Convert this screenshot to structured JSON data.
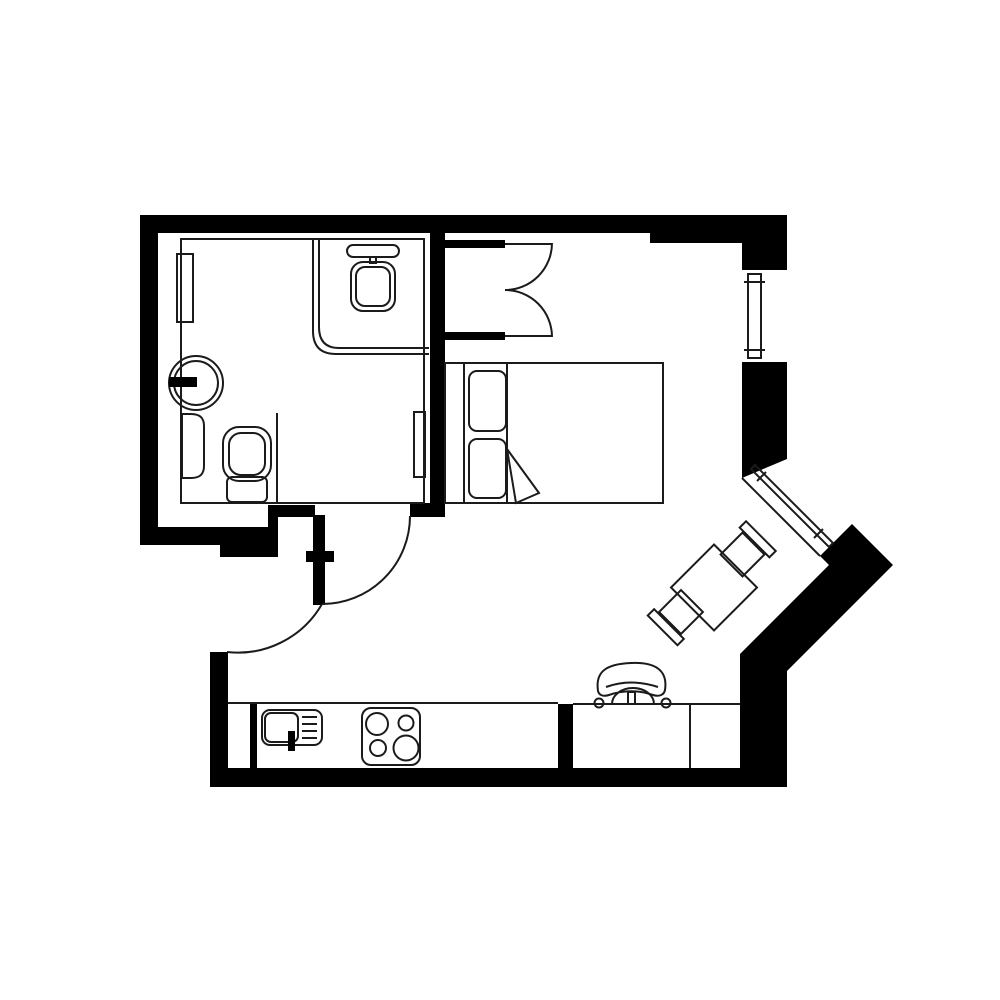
{
  "document": {
    "type": "architectural-floor-plan",
    "style": "black-and-white studio apartment plan",
    "visible_text": []
  },
  "colors": {
    "background": "#ffffff",
    "wall": "#000000",
    "line": "#1b1b1b"
  },
  "rooms": [
    {
      "name": "bathroom",
      "fixtures": [
        "corner-shower-with-showerhead",
        "round-wash-basin-with-tap",
        "toilet-with-cistern",
        "wall-radiator",
        "towel-rail"
      ]
    },
    {
      "name": "closet",
      "fixtures": [
        "double-swing-doors"
      ]
    },
    {
      "name": "bedroom-living-room",
      "fixtures": [
        "double-bed-with-two-pillows-and-folded-sheet",
        "vertical-window",
        "diagonal-bay-window",
        "square-dining-table",
        "dining-chair-northeast",
        "dining-chair-southwest",
        "desk-with-divider",
        "office-chair"
      ]
    },
    {
      "name": "kitchen",
      "fixtures": [
        "counter",
        "sink-with-drainer-and-tap",
        "four-burner-stove"
      ]
    },
    {
      "name": "entry-hall",
      "fixtures": [
        "entry-door-swing",
        "bedroom-door-swing"
      ]
    }
  ],
  "doors": [
    {
      "name": "bedroom-door",
      "type": "single-swing"
    },
    {
      "name": "entry-door",
      "type": "single-swing"
    },
    {
      "name": "closet-doors",
      "type": "double-swing"
    }
  ],
  "windows": [
    {
      "name": "right-wall-window",
      "orientation": "vertical"
    },
    {
      "name": "bay-window",
      "orientation": "diagonal-45deg"
    }
  ]
}
